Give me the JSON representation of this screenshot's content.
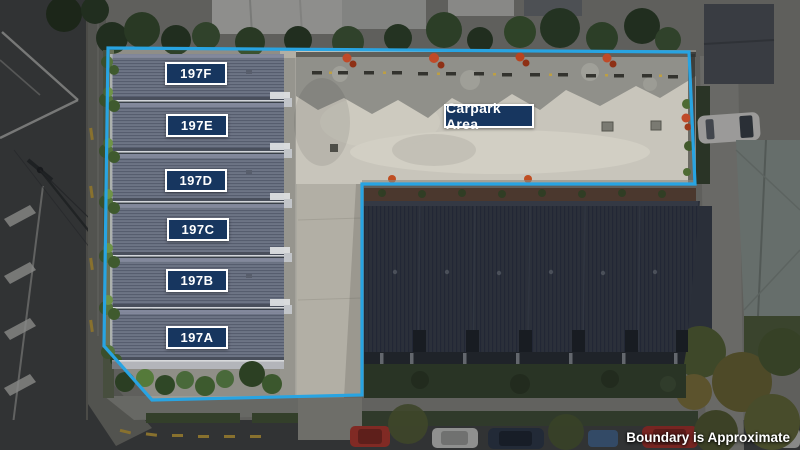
{
  "units": [
    "197F",
    "197E",
    "197D",
    "197C",
    "197B",
    "197A"
  ],
  "carpark_label": "Carpark Area",
  "disclaimer": "Boundary is Approximate",
  "colors": {
    "boundary_line": "#28A4E2",
    "label_background": "#17365F",
    "label_border": "#FFFFFF",
    "label_text": "#FFFFFF"
  }
}
